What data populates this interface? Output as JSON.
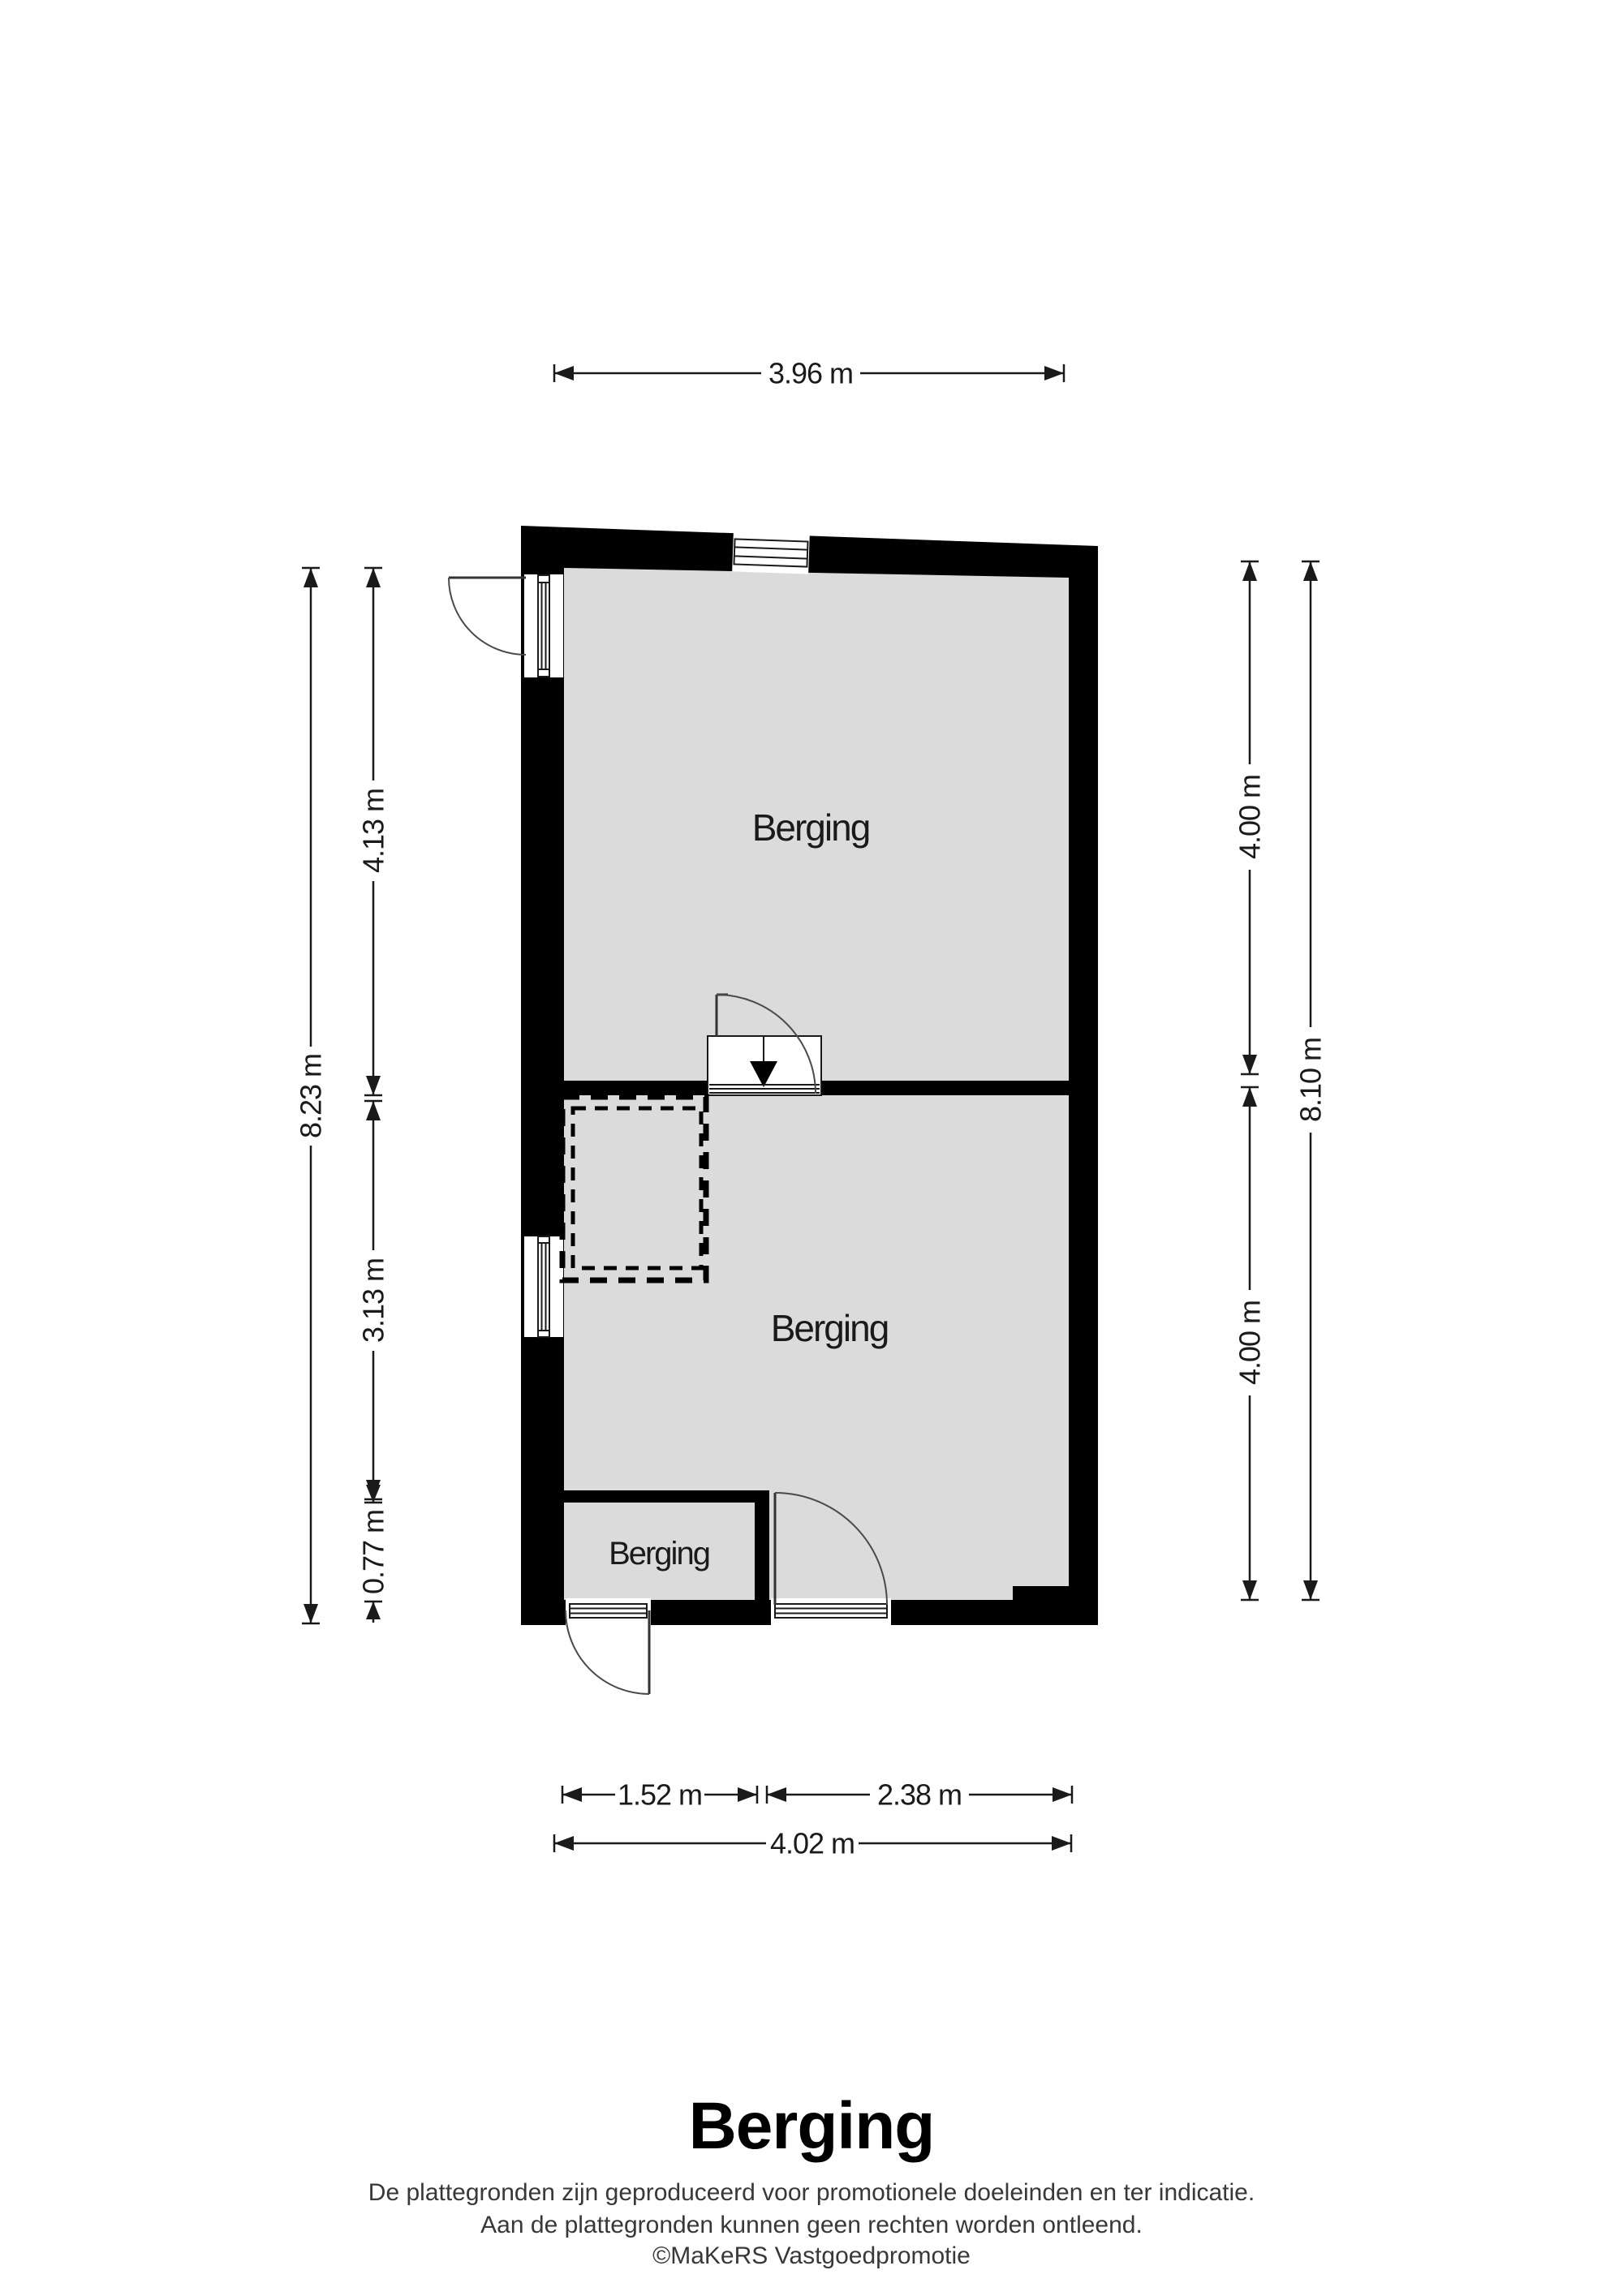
{
  "plan": {
    "rooms": [
      {
        "label": "Berging"
      },
      {
        "label": "Berging"
      },
      {
        "label": "Berging"
      }
    ],
    "dimensions": {
      "top_width": "3.96 m",
      "left_total": "8.23 m",
      "left_upper": "4.13 m",
      "left_middle": "3.13 m",
      "left_lower": "0.77 m",
      "right_upper": "4.00 m",
      "right_lower": "4.00 m",
      "right_total": "8.10 m",
      "bottom_inner_left": "1.52 m",
      "bottom_inner_right": "2.38 m",
      "bottom_total": "4.02 m"
    },
    "colors": {
      "wall": "#000000",
      "floor": "#dbdbdb",
      "dimension_text": "#1a1a1a"
    }
  },
  "footer": {
    "title": "Berging",
    "disclaimer_line1": "De plattegronden zijn geproduceerd voor promotionele doeleinden en ter indicatie.",
    "disclaimer_line2": "Aan de plattegronden kunnen geen rechten worden ontleend.",
    "credit": "©MaKeRS Vastgoedpromotie"
  }
}
